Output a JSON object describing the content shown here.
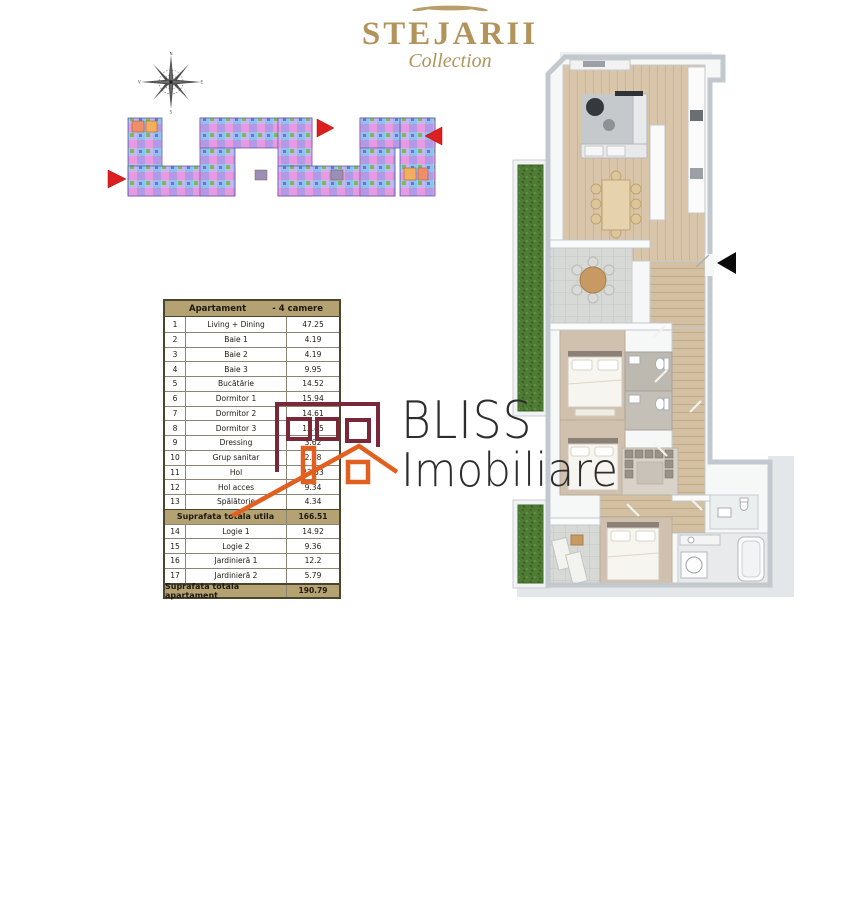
{
  "brand": {
    "title": "STEJARII",
    "subtitle": "Collection",
    "color": "#b2945b"
  },
  "compass": {
    "icon": "compass-rose"
  },
  "site_plan": {
    "description": "serpentine residential building site plan, colored unit mosaic",
    "marker_color": "#de1f1f",
    "unit_colors": [
      "#b39ae6",
      "#e79ade",
      "#8fc3ef",
      "#c9b6f0",
      "#6fbf5f",
      "#f2b05e",
      "#ef8f6a"
    ]
  },
  "area_table": {
    "header_left": "Apartament",
    "header_right": "- 4 camere",
    "header_bg": "#b4a273",
    "rows": [
      {
        "no": "1",
        "label": "Living + Dining",
        "value": "47.25"
      },
      {
        "no": "2",
        "label": "Baie 1",
        "value": "4.19"
      },
      {
        "no": "3",
        "label": "Baie 2",
        "value": "4.19"
      },
      {
        "no": "4",
        "label": "Baie 3",
        "value": "9.95"
      },
      {
        "no": "5",
        "label": "Bucătărie",
        "value": "14.52"
      },
      {
        "no": "6",
        "label": "Dormitor 1",
        "value": "15.94"
      },
      {
        "no": "7",
        "label": "Dormitor 2",
        "value": "14.61"
      },
      {
        "no": "8",
        "label": "Dormitor 3",
        "value": "13.45"
      },
      {
        "no": "9",
        "label": "Dressing",
        "value": "3.62"
      },
      {
        "no": "10",
        "label": "Grup sanitar",
        "value": "2.58"
      },
      {
        "no": "11",
        "label": "Hol",
        "value": "22.53"
      },
      {
        "no": "12",
        "label": "Hol acces",
        "value": "9.34"
      },
      {
        "no": "13",
        "label": "Spălătorie",
        "value": "4.34"
      }
    ],
    "subtotal_label": "Suprafata totala utila",
    "subtotal_value": "166.51",
    "annex_rows": [
      {
        "no": "14",
        "label": "Logie 1",
        "value": "14.92"
      },
      {
        "no": "15",
        "label": "Logie 2",
        "value": "9.36"
      },
      {
        "no": "16",
        "label": "Jardinieră 1",
        "value": "12.2"
      },
      {
        "no": "17",
        "label": "Jardinieră 2",
        "value": "5.79"
      }
    ],
    "total_label": "Suprafata totala apartament",
    "total_value": "190.79"
  },
  "watermark": {
    "title": "BLISS",
    "subtitle": "Imobiliare",
    "text_color": "#2d2d2d",
    "building_color": "#7a2737",
    "house_color": "#e2601f"
  },
  "floor_plan": {
    "entrance_marker": "black left-pointing triangle",
    "features": "4-room apartment 3D top view: living+dining, kitchen, 3 bedrooms, 3 baths, dressing, laundry, 2 loggias, 2 planters"
  }
}
